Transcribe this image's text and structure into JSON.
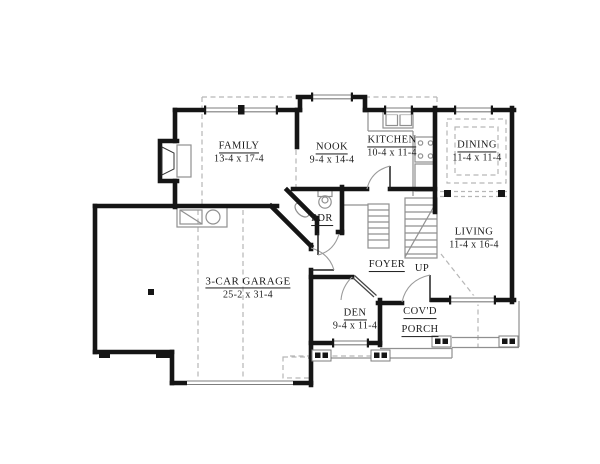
{
  "title": "First floor plan",
  "rooms": {
    "family": {
      "name": "FAMILY",
      "dims": "13-4 x 17-4"
    },
    "nook": {
      "name": "NOOK",
      "dims": "9-4 x 14-4"
    },
    "kitchen": {
      "name": "KITCHEN",
      "dims": "10-4 x 11-4"
    },
    "dining": {
      "name": "DINING",
      "dims": "11-4 x 11-4"
    },
    "powder": {
      "name": "PDR"
    },
    "living": {
      "name": "LIVING",
      "dims": "11-4 x 16-4"
    },
    "foyer": {
      "name": "FOYER"
    },
    "stairs": {
      "direction": "UP"
    },
    "garage": {
      "name": "3-CAR GARAGE",
      "dims": "25-2 x 31-4"
    },
    "den": {
      "name": "DEN",
      "dims": "9-4 x 11-4"
    },
    "porch": {
      "line1": "COV'D",
      "line2": "PORCH"
    }
  },
  "colors": {
    "wall": "#151515",
    "thin_line": "#909090",
    "dashed_line": "#b6b6b6",
    "text": "#1c1c1c",
    "background": "#ffffff"
  }
}
